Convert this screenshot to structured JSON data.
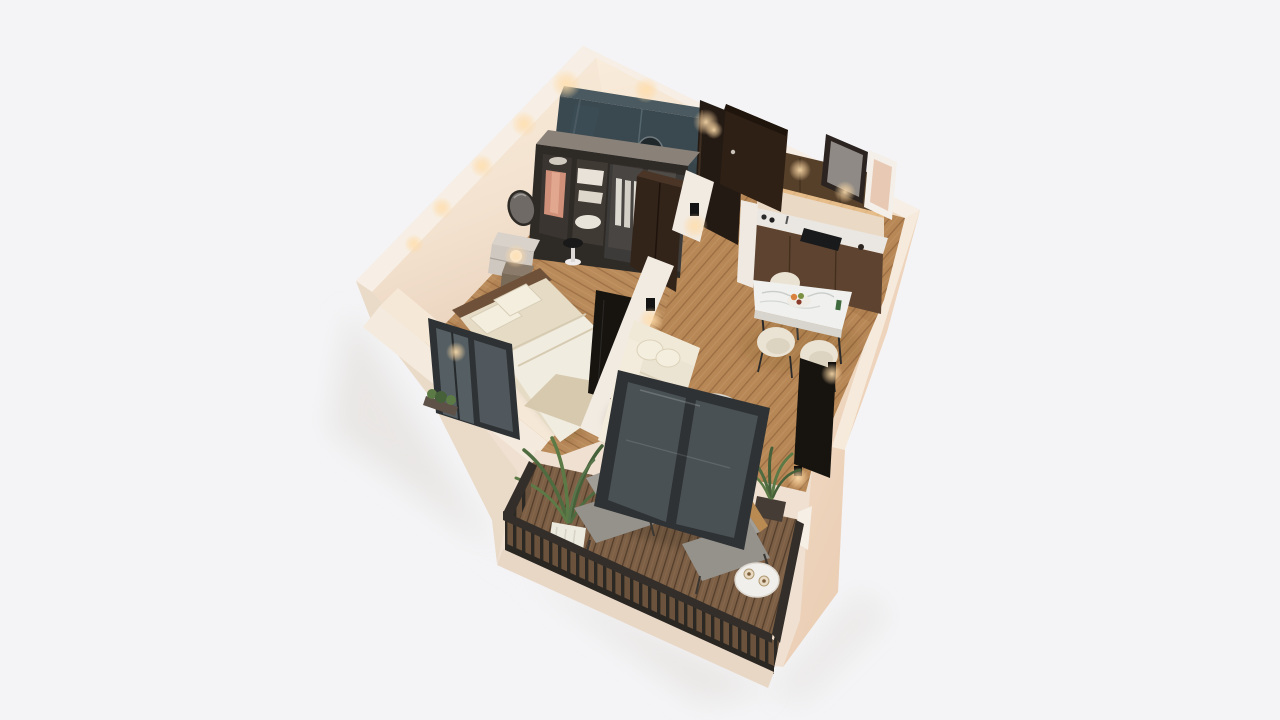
{
  "scene": {
    "type": "3d-floor-plan-render",
    "view": "isometric-top-down",
    "rooms": [
      "bedroom",
      "bathroom",
      "hallway",
      "living-kitchen",
      "balcony"
    ],
    "objects": {
      "bedroom": [
        "double-bed",
        "wardrobe",
        "round-mirror",
        "dresser",
        "stool",
        "nightstand",
        "orb-lamp",
        "tv-panel",
        "framed-window"
      ],
      "bathroom": [
        "smoked-glass-enclosure",
        "round-mirror"
      ],
      "living_kitchen": [
        "kitchen-cabinets",
        "marble-counter",
        "cooktop",
        "entrance-door",
        "wall-mirror",
        "leaning-frame",
        "dining-table",
        "dining-chairs",
        "sofa",
        "coffee-table",
        "wall-tv",
        "potted-plant"
      ],
      "balcony": [
        "wood-deck",
        "slat-railing",
        "lounge-chairs",
        "side-table",
        "potted-plants",
        "glass-door"
      ]
    }
  },
  "colors": {
    "background": "#f4f4f6",
    "shadow": "#e2ded9",
    "slab": "#efe0d1",
    "slab_shade": "#eadbc9",
    "slab_front": "#e9d7c6",
    "wall_top": "#f7efe5",
    "low_wall_top": "#f4eadd",
    "low_wall_inner": "#f6e8d7",
    "floor_wood": "#b98a5a",
    "deck_wood": "#7c5f45",
    "deck_front": "#6a523c",
    "railing": "#332e29",
    "glass_bath": "#32424a",
    "frame_dark": "#2e3234",
    "door_brown": "#2f2015",
    "dark_doorway": "#241a14",
    "cabinet_upper": "#56402a",
    "cabinet_lower": "#5e4430",
    "counter": "#eae6e1",
    "backsplash": "#ead9c5",
    "marble_table": "#f0f1ef",
    "sofa": "#ece4d2",
    "pillow": "#f4eede",
    "bed_linen": "#e6dcc6",
    "sheet": "#f1ece0",
    "blanket": "#d3c5a8",
    "headboard": "#6e5138",
    "wardrobe_case": "#2e2a26",
    "wardrobe_top": "#8a8178",
    "dark_unit": "#33241a",
    "tv_black": "#17140f",
    "chair_cream": "#eae2d2",
    "lounge_gray": "#a19e98",
    "lounge_gray2": "#95928c",
    "table_white": "#f1efeb",
    "plant_green": "#5c7a45",
    "plant_dark": "#46613a",
    "pot_white": "#eceade",
    "pot_dark": "#453c35",
    "glow": "#ffd9a4",
    "stool_seat": "#191919",
    "dresser": "#cfc8c0",
    "mirror_frame": "#2e2a26",
    "mirror_glass": "#6f6a66",
    "white_panel": "#efe9e1",
    "divider": "#f2ebe2"
  }
}
